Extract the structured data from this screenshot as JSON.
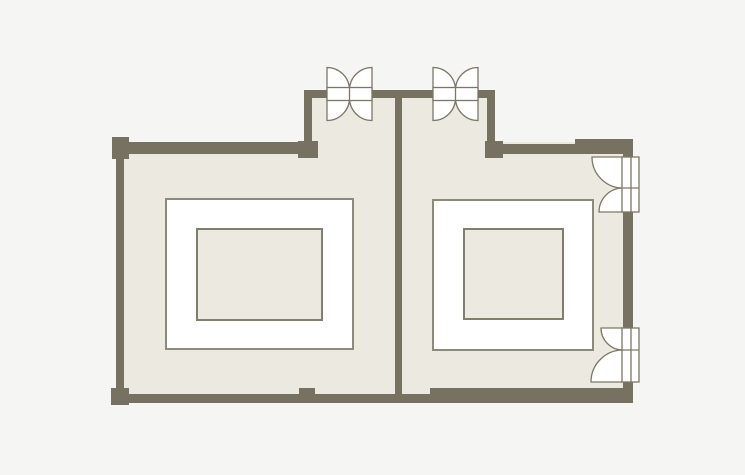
{
  "canvas": {
    "width": 745,
    "height": 475
  },
  "palette": {
    "bg": "#f5f5f3",
    "wall": "#767160",
    "floor": "#eceae0",
    "line": "#7c7767",
    "white": "#ffffff",
    "tableStroke": "#8d8a7c",
    "innerStroke": "#827e6e"
  },
  "floor_plan": {
    "shapes": [
      {
        "type": "rect",
        "name": "background",
        "interactable": false,
        "x": 0,
        "y": 0,
        "w": 745,
        "h": 475,
        "fill": "bg"
      },
      {
        "type": "rect",
        "name": "floor-main",
        "interactable": false,
        "x": 116,
        "y": 142,
        "w": 517,
        "h": 261,
        "fill": "floor"
      },
      {
        "type": "rect",
        "name": "floor-vestibule",
        "interactable": false,
        "x": 304,
        "y": 90,
        "w": 191,
        "h": 63,
        "fill": "floor"
      },
      {
        "type": "rect",
        "name": "wall-top-left",
        "interactable": false,
        "x": 116,
        "y": 142,
        "w": 202,
        "h": 12,
        "fill": "wall"
      },
      {
        "type": "rect",
        "name": "wall-vestibule-left",
        "interactable": false,
        "x": 304,
        "y": 90,
        "w": 8,
        "h": 64,
        "fill": "wall"
      },
      {
        "type": "rect",
        "name": "wall-vestibule-top",
        "interactable": false,
        "x": 304,
        "y": 90,
        "w": 191,
        "h": 8,
        "fill": "wall"
      },
      {
        "type": "rect",
        "name": "wall-vestibule-right",
        "interactable": false,
        "x": 487,
        "y": 90,
        "w": 8,
        "h": 64,
        "fill": "wall"
      },
      {
        "type": "rect",
        "name": "wall-top-right",
        "interactable": false,
        "x": 495,
        "y": 144,
        "w": 80,
        "h": 10,
        "fill": "wall"
      },
      {
        "type": "rect",
        "name": "wall-top-right-thick",
        "interactable": false,
        "x": 575,
        "y": 139,
        "w": 58,
        "h": 15,
        "fill": "wall"
      },
      {
        "type": "rect",
        "name": "wall-right-upper",
        "interactable": false,
        "x": 623,
        "y": 139,
        "w": 10,
        "h": 18,
        "fill": "wall"
      },
      {
        "type": "rect",
        "name": "wall-right-mid",
        "interactable": false,
        "x": 623,
        "y": 212,
        "w": 10,
        "h": 116,
        "fill": "wall"
      },
      {
        "type": "rect",
        "name": "wall-right-lower",
        "interactable": false,
        "x": 623,
        "y": 382,
        "w": 10,
        "h": 21,
        "fill": "wall"
      },
      {
        "type": "rect",
        "name": "wall-left",
        "interactable": false,
        "x": 116,
        "y": 154,
        "w": 8,
        "h": 240,
        "fill": "wall"
      },
      {
        "type": "rect",
        "name": "wall-bottom-left",
        "interactable": false,
        "x": 112,
        "y": 394,
        "w": 318,
        "h": 9,
        "fill": "wall"
      },
      {
        "type": "rect",
        "name": "wall-bottom-right-thick",
        "interactable": false,
        "x": 430,
        "y": 388,
        "w": 203,
        "h": 15,
        "fill": "wall"
      },
      {
        "type": "rect",
        "name": "wall-divider",
        "interactable": false,
        "x": 395,
        "y": 98,
        "w": 7,
        "h": 305,
        "fill": "wall"
      },
      {
        "type": "rect",
        "name": "pillar-top-left",
        "interactable": false,
        "x": 112,
        "y": 137,
        "w": 17,
        "h": 22,
        "fill": "wall"
      },
      {
        "type": "rect",
        "name": "pillar-bottom-left",
        "interactable": false,
        "x": 111,
        "y": 388,
        "w": 18,
        "h": 17,
        "fill": "wall"
      },
      {
        "type": "rect",
        "name": "pillar-bottom-center",
        "interactable": false,
        "x": 299,
        "y": 388,
        "w": 16,
        "h": 15,
        "fill": "wall"
      },
      {
        "type": "rect",
        "name": "pillar-vestibule-left",
        "interactable": false,
        "x": 298,
        "y": 141,
        "w": 20,
        "h": 17,
        "fill": "wall"
      },
      {
        "type": "rect",
        "name": "pillar-vestibule-right",
        "interactable": false,
        "x": 485,
        "y": 141,
        "w": 18,
        "h": 17,
        "fill": "wall"
      },
      {
        "type": "rect",
        "name": "table-left-outer",
        "interactable": true,
        "x": 166,
        "y": 199,
        "w": 187,
        "h": 150,
        "fill": "white",
        "stroke": "tableStroke",
        "sw": 2
      },
      {
        "type": "rect",
        "name": "table-left-inner",
        "interactable": true,
        "x": 197,
        "y": 229,
        "w": 125,
        "h": 91,
        "fill": "floor",
        "stroke": "innerStroke",
        "sw": 2
      },
      {
        "type": "rect",
        "name": "table-right-outer",
        "interactable": true,
        "x": 433,
        "y": 200,
        "w": 160,
        "h": 150,
        "fill": "white",
        "stroke": "tableStroke",
        "sw": 2
      },
      {
        "type": "rect",
        "name": "table-right-inner",
        "interactable": true,
        "x": 464,
        "y": 229,
        "w": 99,
        "h": 90,
        "fill": "floor",
        "stroke": "innerStroke",
        "sw": 2
      },
      {
        "type": "path",
        "name": "door-north-left-swing-top-left",
        "interactable": true,
        "d": "M 327 90 L 327 67.5 A 22.5 22.5 0 0 1 349.5 90 Z",
        "fill": "white",
        "stroke": "line",
        "sw": 1.3
      },
      {
        "type": "path",
        "name": "door-north-left-swing-top-right",
        "interactable": true,
        "d": "M 372 90 L 349.5 90 A 22.5 22.5 0 0 1 372 67.5 Z",
        "fill": "white",
        "stroke": "line",
        "sw": 1.3
      },
      {
        "type": "path",
        "name": "door-north-left-swing-bottom-left",
        "interactable": true,
        "d": "M 327 98 L 349.5 98 A 22.5 22.5 0 0 1 327 120.5 Z",
        "fill": "white",
        "stroke": "line",
        "sw": 1.3
      },
      {
        "type": "path",
        "name": "door-north-left-swing-bottom-right",
        "interactable": true,
        "d": "M 372 98 L 372 120.5 A 22.5 22.5 0 0 1 349.5 98 Z",
        "fill": "white",
        "stroke": "line",
        "sw": 1.3
      },
      {
        "type": "rect",
        "name": "door-north-left-leaves",
        "interactable": true,
        "x": 327,
        "y": 87.5,
        "w": 45,
        "h": 13,
        "fill": "white",
        "stroke": "line",
        "sw": 1.3
      },
      {
        "type": "line",
        "name": "door-north-left-meet-line",
        "interactable": false,
        "x1": 349.5,
        "y1": 87.5,
        "x2": 349.5,
        "y2": 100.5,
        "stroke": "line",
        "sw": 1.3
      },
      {
        "type": "path",
        "name": "door-north-right-swing-top-left",
        "interactable": true,
        "d": "M 433 90 L 433 67.5 A 22.5 22.5 0 0 1 455.5 90 Z",
        "fill": "white",
        "stroke": "line",
        "sw": 1.3
      },
      {
        "type": "path",
        "name": "door-north-right-swing-top-right",
        "interactable": true,
        "d": "M 478 90 L 455.5 90 A 22.5 22.5 0 0 1 478 67.5 Z",
        "fill": "white",
        "stroke": "line",
        "sw": 1.3
      },
      {
        "type": "path",
        "name": "door-north-right-swing-bottom-left",
        "interactable": true,
        "d": "M 433 98 L 455.5 98 A 22.5 22.5 0 0 1 433 120.5 Z",
        "fill": "white",
        "stroke": "line",
        "sw": 1.3
      },
      {
        "type": "path",
        "name": "door-north-right-swing-bottom-right",
        "interactable": true,
        "d": "M 478 98 L 478 120.5 A 22.5 22.5 0 0 1 455.5 98 Z",
        "fill": "white",
        "stroke": "line",
        "sw": 1.3
      },
      {
        "type": "rect",
        "name": "door-north-right-leaves",
        "interactable": true,
        "x": 433,
        "y": 87.5,
        "w": 45,
        "h": 13,
        "fill": "white",
        "stroke": "line",
        "sw": 1.3
      },
      {
        "type": "line",
        "name": "door-north-right-meet-line",
        "interactable": false,
        "x1": 455.5,
        "y1": 87.5,
        "x2": 455.5,
        "y2": 100.5,
        "stroke": "line",
        "sw": 1.3
      },
      {
        "type": "path",
        "name": "door-east-upper-swing-large",
        "interactable": true,
        "d": "M 623 157 L 592 157 A 31 31 0 0 0 623 188 Z",
        "fill": "white",
        "stroke": "line",
        "sw": 1.3
      },
      {
        "type": "path",
        "name": "door-east-upper-swing-small",
        "interactable": true,
        "d": "M 623 212 L 599 212 A 24 24 0 0 1 623 188 Z",
        "fill": "white",
        "stroke": "line",
        "sw": 1.3
      },
      {
        "type": "rect",
        "name": "door-east-upper-leaves",
        "interactable": true,
        "x": 622,
        "y": 157,
        "w": 17,
        "h": 55,
        "fill": "white",
        "stroke": "line",
        "sw": 1.3
      },
      {
        "type": "line",
        "name": "door-east-upper-meet-line",
        "interactable": false,
        "x1": 622,
        "y1": 188,
        "x2": 639,
        "y2": 188,
        "stroke": "line",
        "sw": 1.3
      },
      {
        "type": "line",
        "name": "door-east-upper-jamb-line",
        "interactable": false,
        "x1": 631,
        "y1": 157,
        "x2": 631,
        "y2": 212,
        "stroke": "line",
        "sw": 1.3
      },
      {
        "type": "path",
        "name": "door-east-lower-swing-small",
        "interactable": true,
        "d": "M 623 328 L 601 328 A 22 22 0 0 0 623 350 Z",
        "fill": "white",
        "stroke": "line",
        "sw": 1.3
      },
      {
        "type": "path",
        "name": "door-east-lower-swing-large",
        "interactable": true,
        "d": "M 623 382 L 591 382 A 32 32 0 0 1 623 350 Z",
        "fill": "white",
        "stroke": "line",
        "sw": 1.3
      },
      {
        "type": "rect",
        "name": "door-east-lower-leaves",
        "interactable": true,
        "x": 622,
        "y": 328,
        "w": 17,
        "h": 54,
        "fill": "white",
        "stroke": "line",
        "sw": 1.3
      },
      {
        "type": "line",
        "name": "door-east-lower-meet-line",
        "interactable": false,
        "x1": 622,
        "y1": 350,
        "x2": 639,
        "y2": 350,
        "stroke": "line",
        "sw": 1.3
      },
      {
        "type": "line",
        "name": "door-east-lower-jamb-line",
        "interactable": false,
        "x1": 631,
        "y1": 328,
        "x2": 631,
        "y2": 382,
        "stroke": "line",
        "sw": 1.3
      }
    ]
  }
}
